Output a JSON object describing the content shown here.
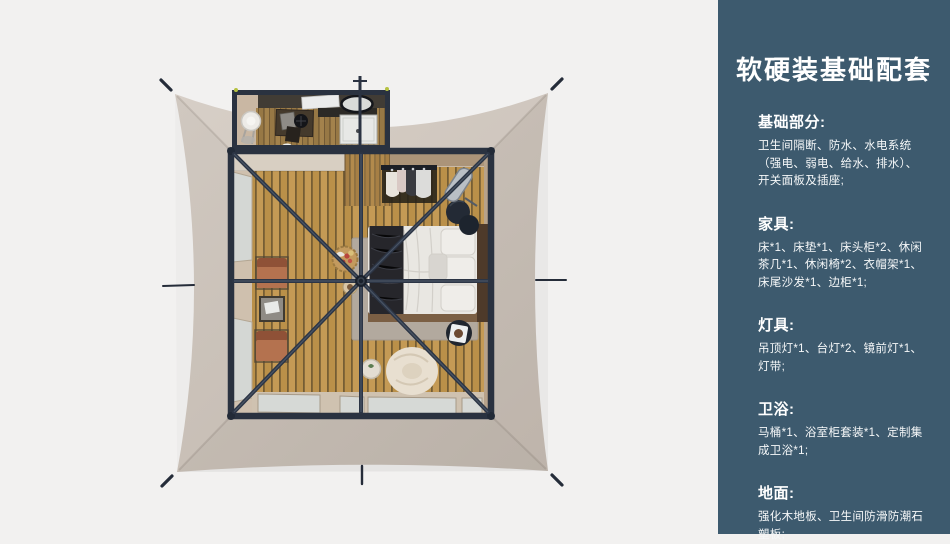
{
  "panel": {
    "title": "软硬装基础配套",
    "sections": [
      {
        "id": "basics",
        "heading": "基础部分:",
        "body": "卫生间隔断、防水、水电系统\n（强电、弱电、给水、排水）、\n开关面板及插座;"
      },
      {
        "id": "furniture",
        "heading": "家具:",
        "body": "床*1、床垫*1、床头柜*2、休闲\n茶几*1、休闲椅*2、衣帽架*1、\n床尾沙发*1、边柜*1;"
      },
      {
        "id": "lighting",
        "heading": "灯具:",
        "body": "吊顶灯*1、台灯*2、镜前灯*1、\n灯带;"
      },
      {
        "id": "bath",
        "heading": "卫浴:",
        "body": "马桶*1、浴室柜套装*1、定制集\n成卫浴*1;"
      },
      {
        "id": "floor",
        "heading": "地面:",
        "body": "强化木地板、卫生间防滑防潮石\n塑板;"
      }
    ]
  },
  "colors": {
    "background": "#f2f1f0",
    "panel_bg": "#3d5a6e",
    "panel_text": "#ffffff",
    "canvas": "#cdc3ba",
    "frame": "#2a3240",
    "brace": "#2c3545",
    "wood_plank": "#c49a55",
    "accent_light": "#b6c242",
    "chair": "#b4724f",
    "bedding": "#e9e7e2",
    "throw_blanket": "#26262b"
  }
}
